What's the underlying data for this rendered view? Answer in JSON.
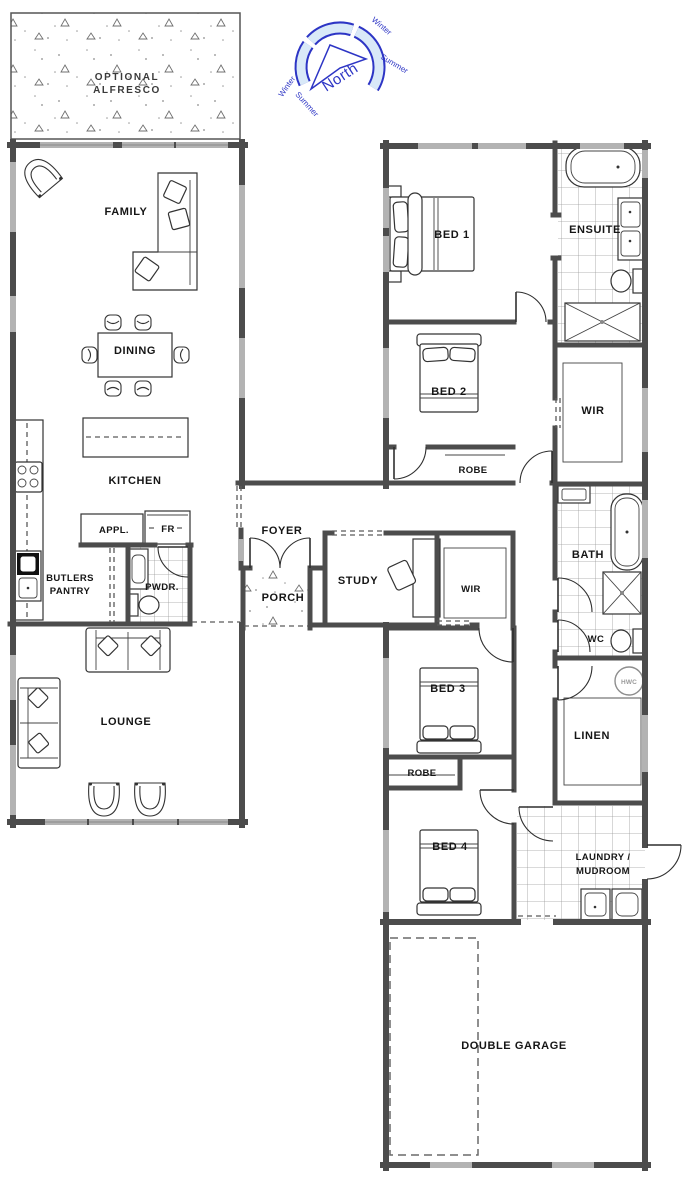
{
  "rooms": {
    "alfresco1": "OPTIONAL",
    "alfresco2": "ALFRESCO",
    "family": "FAMILY",
    "dining": "DINING",
    "kitchen": "KITCHEN",
    "appl": "APPL.",
    "fr": "FR",
    "butlers1": "BUTLERS",
    "butlers2": "PANTRY",
    "pwdr": "PWDR.",
    "lounge": "LOUNGE",
    "foyer": "FOYER",
    "porch": "PORCH",
    "study": "STUDY",
    "wir": "WIR",
    "robe": "ROBE",
    "bed1": "BED 1",
    "bed2": "BED 2",
    "bed3": "BED 3",
    "bed4": "BED 4",
    "ensuite": "ENSUITE",
    "bath": "BATH",
    "wc": "WC",
    "hwc": "HWC",
    "linen": "LINEN",
    "laundry1": "LAUNDRY /",
    "laundry2": "MUDROOM",
    "garage": "DOUBLE GARAGE"
  },
  "compass": {
    "north": "North",
    "winter": "Winter",
    "summer": "Summer"
  },
  "colors": {
    "wall": "#4c4c4c",
    "window": "#b3b3b3",
    "tile": "#9b9b9b",
    "compass_blue": "#2d35c5",
    "compass_fill": "#d9e9f8",
    "label": "#151515"
  }
}
